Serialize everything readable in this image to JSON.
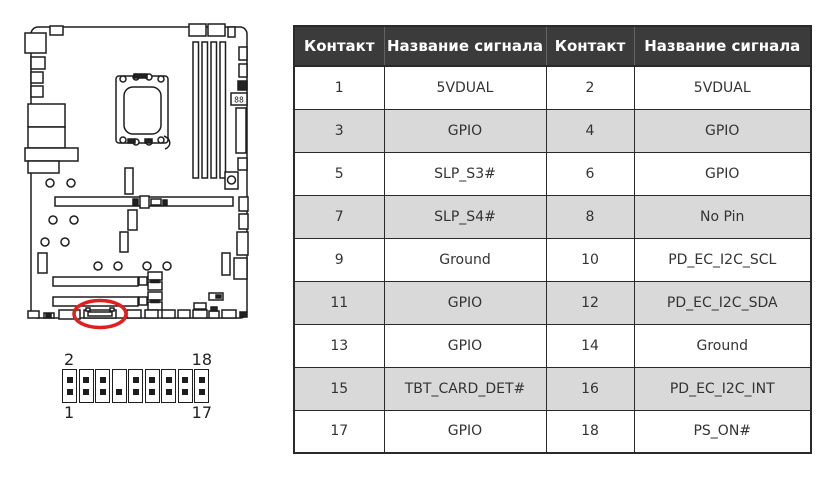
{
  "table": {
    "headers": [
      "Контакт",
      "Название сигнала",
      "Контакт",
      "Название сигнала"
    ],
    "rows": [
      [
        "1",
        "5VDUAL",
        "2",
        "5VDUAL"
      ],
      [
        "3",
        "GPIO",
        "4",
        "GPIO"
      ],
      [
        "5",
        "SLP_S3#",
        "6",
        "GPIO"
      ],
      [
        "7",
        "SLP_S4#",
        "8",
        "No Pin"
      ],
      [
        "9",
        "Ground",
        "10",
        "PD_EC_I2C_SCL"
      ],
      [
        "11",
        "GPIO",
        "12",
        "PD_EC_I2C_SDA"
      ],
      [
        "13",
        "GPIO",
        "14",
        "Ground"
      ],
      [
        "15",
        "TBT_CARD_DET#",
        "16",
        "PD_EC_I2C_INT"
      ],
      [
        "17",
        "GPIO",
        "18",
        "PS_ON#"
      ]
    ],
    "colors": {
      "header_bg": "#3b3b3b",
      "header_text": "#ffffff",
      "row_alt_bg": "#d9d9d9",
      "row_bg": "#ffffff",
      "border": "#2a2a2a"
    }
  },
  "pin_header": {
    "labels": {
      "top_left": "2",
      "top_right": "18",
      "bottom_left": "1",
      "bottom_right": "17"
    },
    "columns": 9,
    "rows": 2,
    "missing_pin": {
      "column": 4,
      "row": "top"
    }
  },
  "board_diagram": {
    "debug_led_text": "88",
    "highlight_color": "#e01f1f"
  }
}
